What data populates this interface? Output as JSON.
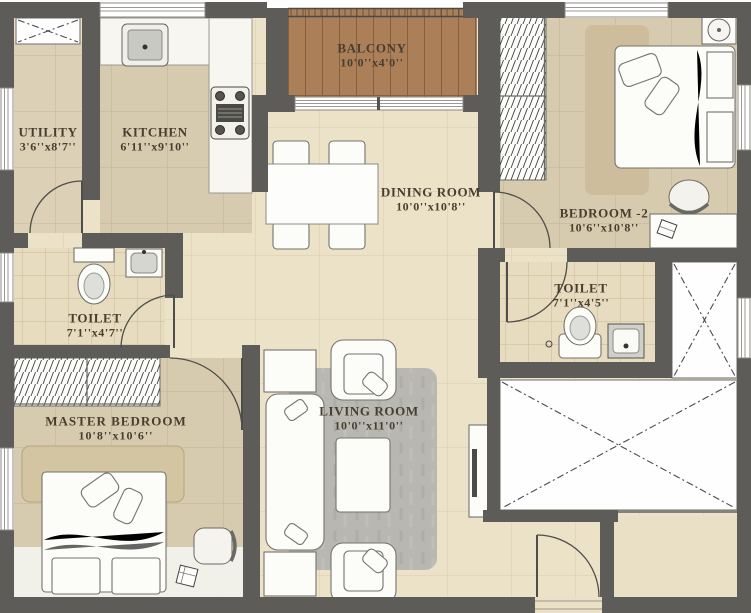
{
  "rooms": [
    {
      "name": "UTILITY",
      "size": "3'6''x8'7''"
    },
    {
      "name": "KITCHEN",
      "size": "6'11''x9'10''"
    },
    {
      "name": "BALCONY",
      "size": "10'0''x4'0''"
    },
    {
      "name": "DINING ROOM",
      "size": "10'0''x10'8''"
    },
    {
      "name": "BEDROOM -2",
      "size": "10'6''x10'8''"
    },
    {
      "name": "TOILET",
      "size": "7'1''x4'7''"
    },
    {
      "name": "MASTER BEDROOM",
      "size": "10'8''x10'6''"
    },
    {
      "name": "LIVING ROOM",
      "size": "10'0''x11'0''"
    },
    {
      "name": "TOILET",
      "size": "7'1''x4'5''"
    }
  ],
  "colors": {
    "wall": "#5e5c58",
    "floor_cream": "#ebe2c8",
    "floor_tan": "#d7cbaf",
    "floor_tile": "#e7dcbf",
    "balcony_wood": "#ab7f58",
    "rug_gray": "#b9b7b2",
    "fixture_white": "#fcfcf9",
    "label_text": "#473e30"
  }
}
